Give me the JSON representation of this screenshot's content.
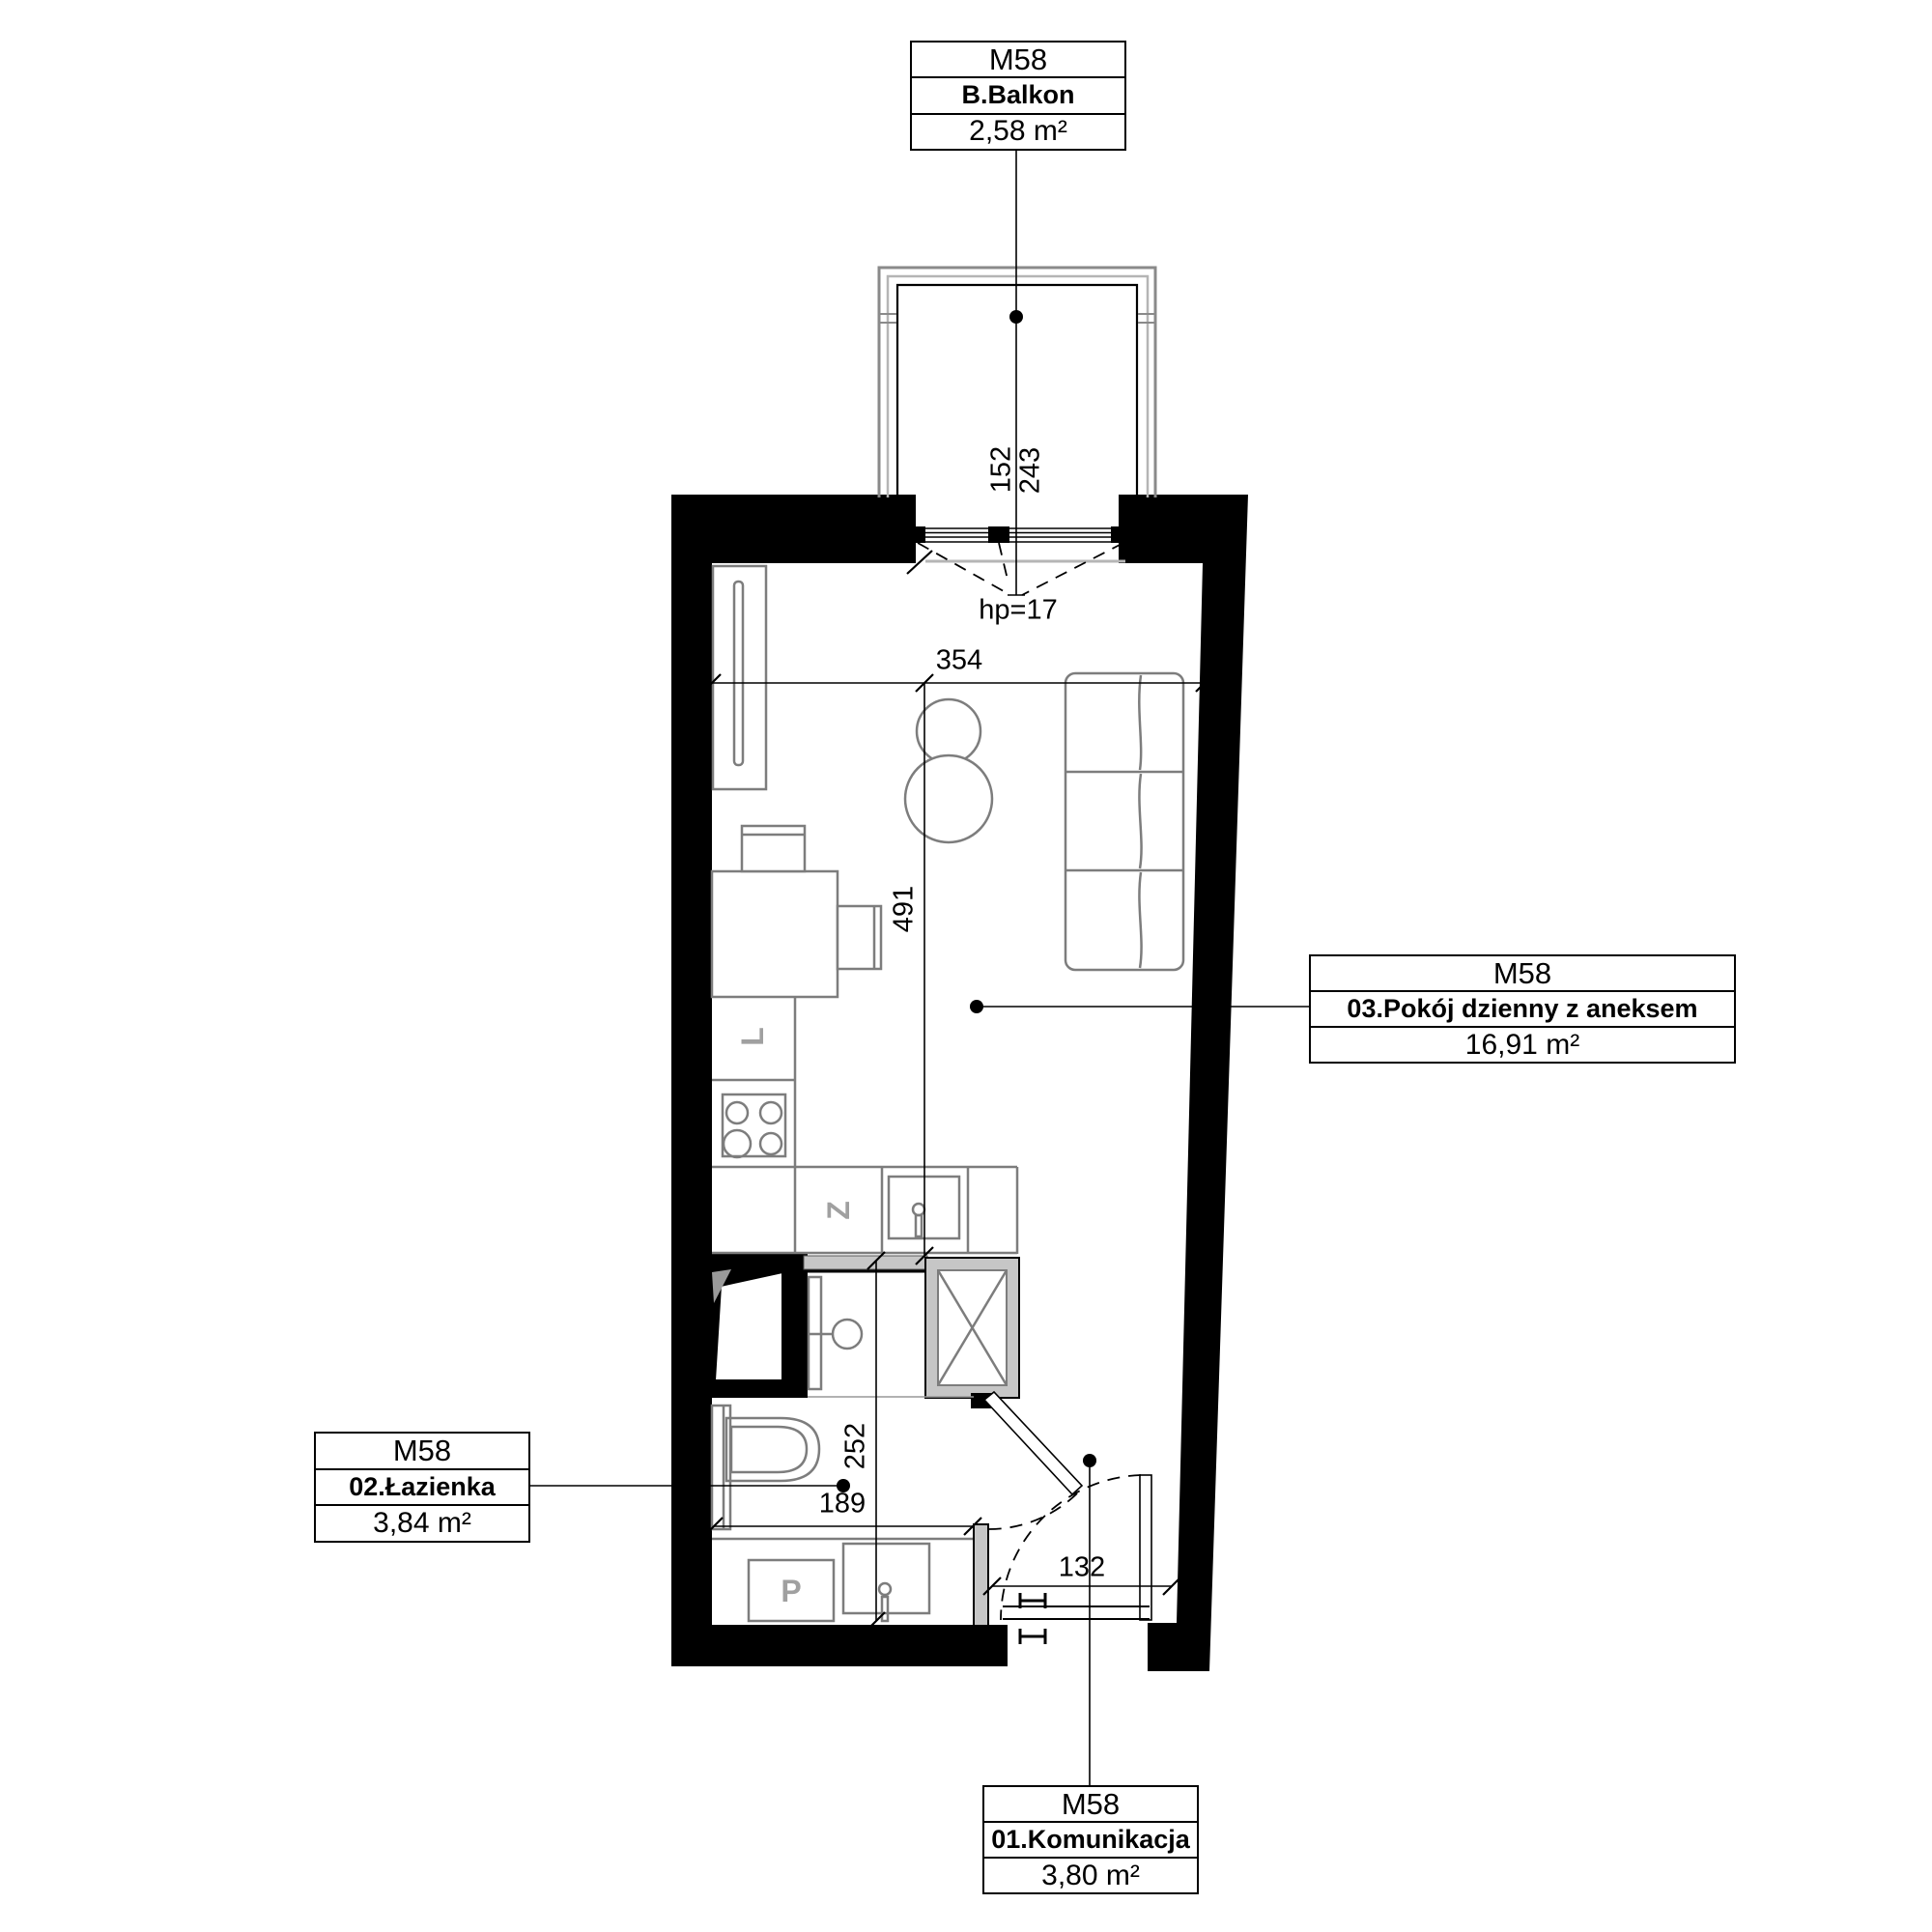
{
  "unit_code": "M58",
  "rooms": {
    "balcony": {
      "unit": "M58",
      "name": "B.Balkon",
      "area": "2,58 m²"
    },
    "living": {
      "unit": "M58",
      "name": "03.Pokój dzienny z aneksem",
      "area": "16,91 m²"
    },
    "bathroom": {
      "unit": "M58",
      "name": "02.Łazienka",
      "area": "3,84 m²"
    },
    "hall": {
      "unit": "M58",
      "name": "01.Komunikacja",
      "area": "3,80 m²"
    }
  },
  "dimensions": {
    "balcony_depth": "152",
    "balcony_width": "243",
    "window_sill": "hp=17",
    "living_width": "354",
    "living_length": "491",
    "bathroom_length": "252",
    "bathroom_width": "189",
    "hall_width": "132"
  },
  "appliance_labels": {
    "fridge": "L",
    "dishwasher": "Z",
    "washer": "P"
  },
  "colors": {
    "wall": "#000000",
    "gray_fill": "#c6c6c6",
    "furniture_stroke": "#7d7d7d",
    "rail_outer": "#8a8a8a",
    "rail_inner": "#b5b5b5",
    "appliance_label": "#a0a0a0",
    "background": "#ffffff"
  }
}
